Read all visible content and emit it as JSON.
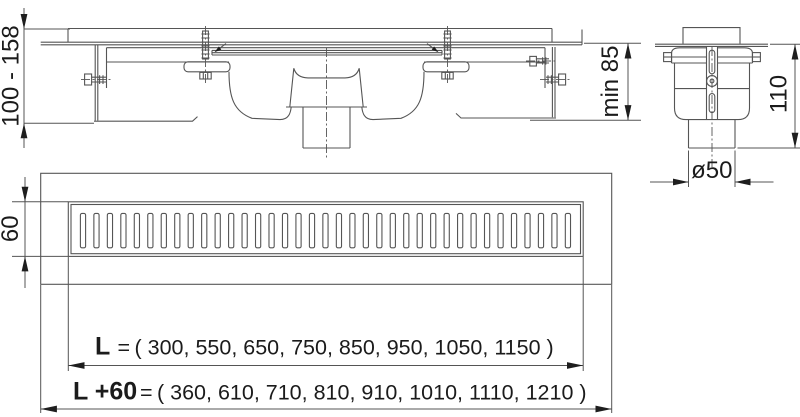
{
  "drawing": {
    "title_hint": "floor-drain-channel-technical-drawing",
    "dimensions": {
      "height_range": "100 - 158",
      "min_depth": "min 85",
      "trap_height": "110",
      "pipe_diameter": "ø50",
      "grate_width": "60",
      "length_label": "L",
      "length_eq": "=",
      "length_values": "( 300, 550, 650, 750, 850, 950, 1050, 1150 )",
      "overall_label": "L +60",
      "overall_eq": "=",
      "overall_values": "( 360, 610, 710, 810, 910, 1010, 1110, 1210 )"
    },
    "grate": {
      "slot_count": 37
    },
    "colors": {
      "line": "#555555",
      "text": "#1b1b1b",
      "arrow": "#1e1e1e",
      "background": "#ffffff"
    }
  }
}
